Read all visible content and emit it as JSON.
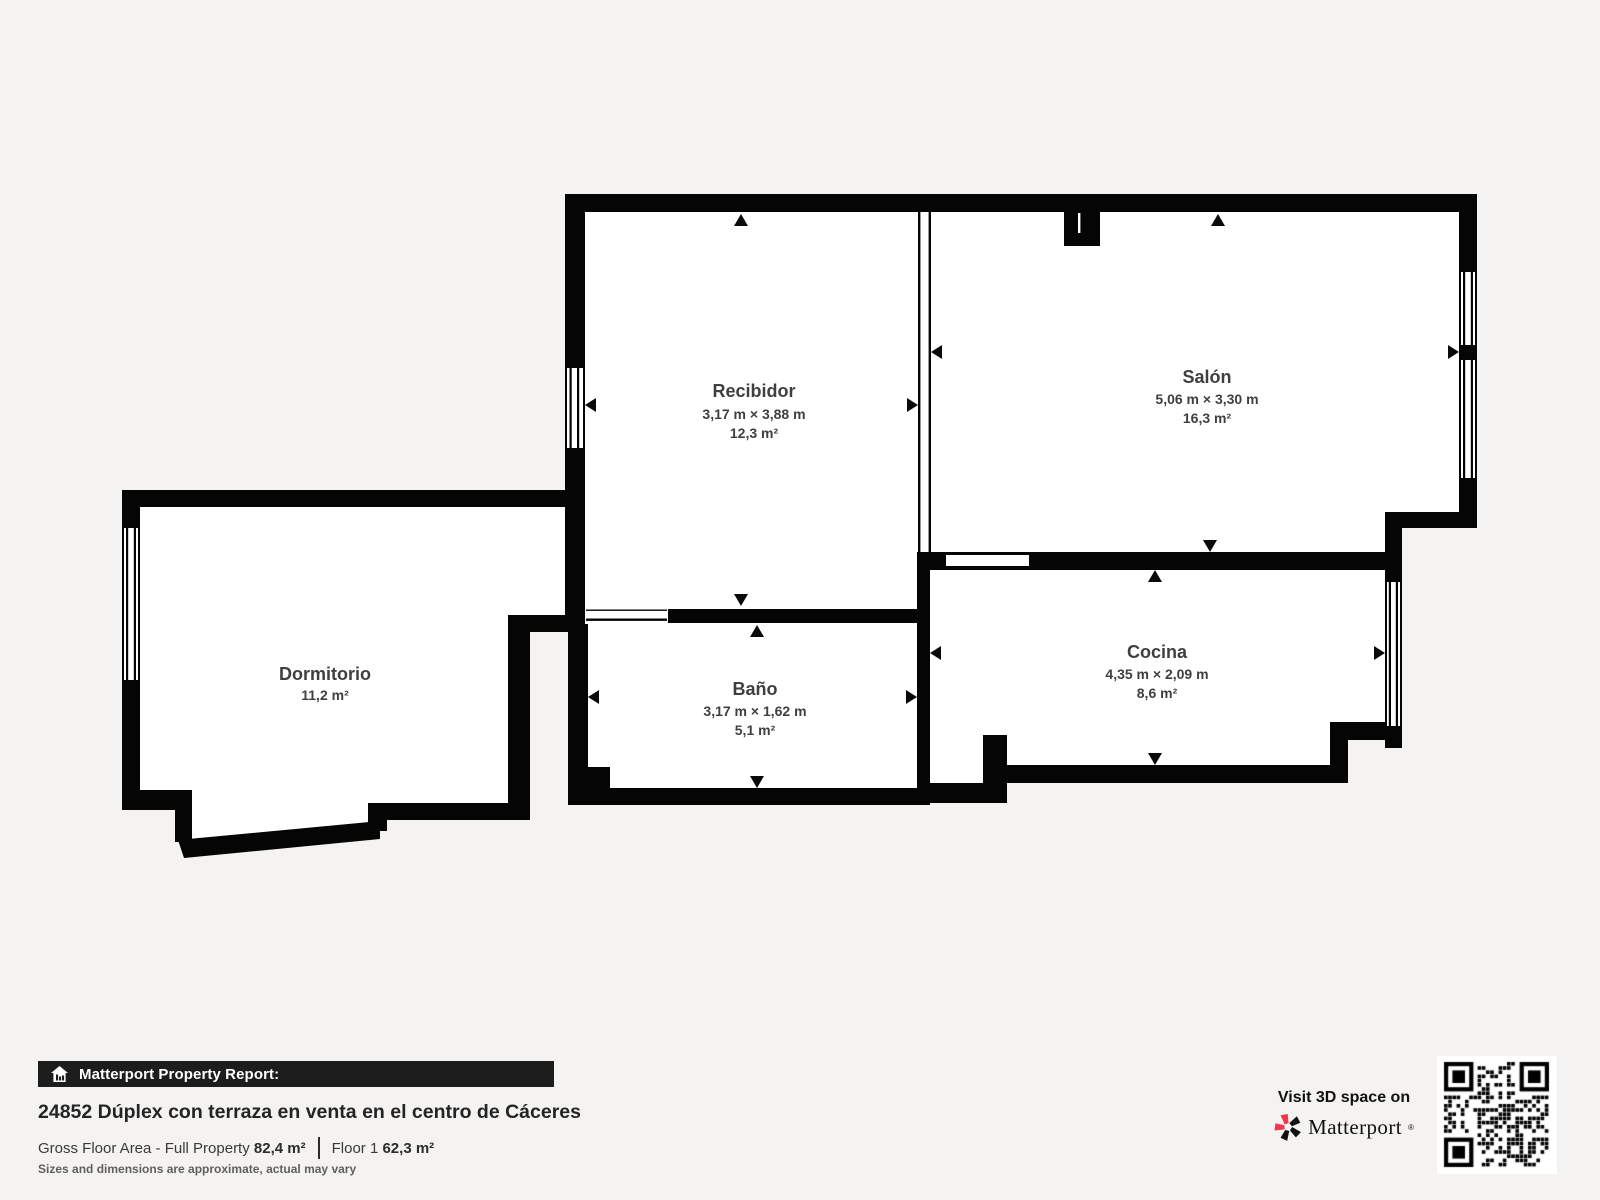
{
  "colors": {
    "background": "#f4f3f1",
    "wall": "#050505",
    "room_fill": "#ffffff",
    "label_text": "#3f3f3f",
    "bar_background": "#1d1d1d",
    "accent_red": "#f4364c"
  },
  "rooms": [
    {
      "name": "Recibidor",
      "dimensions": "3,17 m × 3,88 m",
      "area": "12,3 m²"
    },
    {
      "name": "Salón",
      "dimensions": "5,06 m × 3,30 m",
      "area": "16,3 m²"
    },
    {
      "name": "Dormitorio",
      "area": "11,2 m²"
    },
    {
      "name": "Baño",
      "dimensions": "3,17 m × 1,62 m",
      "area": "5,1 m²"
    },
    {
      "name": "Cocina",
      "dimensions": "4,35 m × 2,09 m",
      "area": "8,6 m²"
    }
  ],
  "footer": {
    "report_label": "Matterport Property Report:",
    "title": "24852 Dúplex con terraza en venta en el centro de Cáceres",
    "gross_label": "Gross Floor Area - Full Property",
    "gross_value": "82,4 m²",
    "floor_label": "Floor 1",
    "floor_value": "62,3 m²",
    "disclaimer": "Sizes and dimensions are approximate, actual may vary"
  },
  "cta": {
    "visit_label": "Visit 3D space on",
    "brand": "Matterport",
    "brand_mark": "®"
  }
}
